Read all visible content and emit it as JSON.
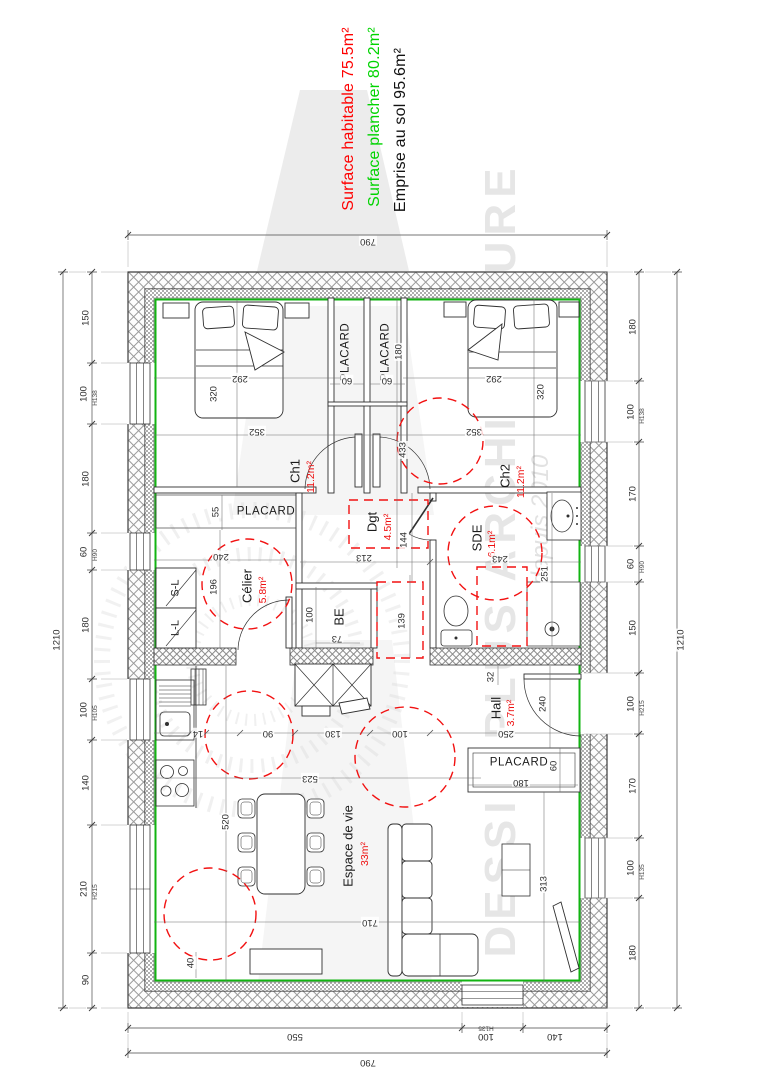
{
  "title_block": {
    "lines": [
      {
        "text": "Surface habitable 75.5m²",
        "color": "#ff0000"
      },
      {
        "text": "Surface plancher 80.2m²",
        "color": "#00d400"
      },
      {
        "text": "Emprise au sol 95.6m²",
        "color": "#121212"
      }
    ]
  },
  "watermark": {
    "name": "DESSIN PLUS ARCHITECTURE",
    "tagline": "depuis 2010"
  },
  "colors": {
    "surface_habitable_red": "#ff0000",
    "surface_plancher_green": "#00d400",
    "perimeter_green": "#12b412",
    "clearance_red": "#f21111",
    "wall_hatch_gray": "#9a9a9a"
  },
  "plan": {
    "overall": {
      "width_cm": "790",
      "height_cm": "1210"
    },
    "rooms": [
      {
        "name": "Ch1",
        "area": "11.2m²"
      },
      {
        "name": "Ch2",
        "area": "11.2m²"
      },
      {
        "name": "Dgt",
        "area": "4.5m²"
      },
      {
        "name": "SDE",
        "area": "6.1m²"
      },
      {
        "name": "Célier",
        "area": "5.8m²"
      },
      {
        "name": "Hall",
        "area": "3.7m²"
      },
      {
        "name": "Espace de vie",
        "area": "33m²"
      },
      {
        "name": "BE"
      },
      {
        "name": "S-L"
      },
      {
        "name": "L-L"
      },
      {
        "name": "PLACARD"
      }
    ],
    "labels": [
      {
        "t": "790",
        "x": 368,
        "y": 241,
        "r": 180,
        "c": "d"
      },
      {
        "t": "550",
        "x": 295,
        "y": 1036,
        "r": 180,
        "c": "d"
      },
      {
        "t": "100",
        "x": 486,
        "y": 1036,
        "r": 180,
        "c": "d"
      },
      {
        "t": "H135",
        "x": 486,
        "y": 1027,
        "r": 180,
        "c": "dt"
      },
      {
        "t": "140",
        "x": 555,
        "y": 1036,
        "r": 180,
        "c": "d"
      },
      {
        "t": "790",
        "x": 368,
        "y": 1062,
        "r": 180,
        "c": "d"
      },
      {
        "t": "1210",
        "x": 57,
        "y": 640,
        "r": -90,
        "c": "d"
      },
      {
        "t": "150",
        "x": 86,
        "y": 318,
        "r": -90,
        "c": "d"
      },
      {
        "t": "100",
        "x": 84,
        "y": 394,
        "r": -90,
        "c": "d"
      },
      {
        "t": "H138",
        "x": 96,
        "y": 398,
        "r": -90,
        "c": "dt"
      },
      {
        "t": "180",
        "x": 86,
        "y": 479,
        "r": -90,
        "c": "d"
      },
      {
        "t": "60",
        "x": 84,
        "y": 552,
        "r": -90,
        "c": "d"
      },
      {
        "t": "H90",
        "x": 96,
        "y": 555,
        "r": -90,
        "c": "dt"
      },
      {
        "t": "180",
        "x": 86,
        "y": 625,
        "r": -90,
        "c": "d"
      },
      {
        "t": "100",
        "x": 84,
        "y": 710,
        "r": -90,
        "c": "d"
      },
      {
        "t": "H105",
        "x": 96,
        "y": 713,
        "r": -90,
        "c": "dt"
      },
      {
        "t": "140",
        "x": 86,
        "y": 783,
        "r": -90,
        "c": "d"
      },
      {
        "t": "210",
        "x": 84,
        "y": 889,
        "r": -90,
        "c": "d"
      },
      {
        "t": "H215",
        "x": 96,
        "y": 892,
        "r": -90,
        "c": "dt"
      },
      {
        "t": "90",
        "x": 86,
        "y": 980,
        "r": -90,
        "c": "d"
      },
      {
        "t": "1210",
        "x": 681,
        "y": 640,
        "r": -90,
        "c": "d"
      },
      {
        "t": "180",
        "x": 633,
        "y": 327,
        "r": -90,
        "c": "d"
      },
      {
        "t": "100",
        "x": 631,
        "y": 412,
        "r": -90,
        "c": "d"
      },
      {
        "t": "H138",
        "x": 643,
        "y": 416,
        "r": -90,
        "c": "dt"
      },
      {
        "t": "170",
        "x": 633,
        "y": 494,
        "r": -90,
        "c": "d"
      },
      {
        "t": "60",
        "x": 631,
        "y": 564,
        "r": -90,
        "c": "d"
      },
      {
        "t": "H90",
        "x": 643,
        "y": 567,
        "r": -90,
        "c": "dt"
      },
      {
        "t": "150",
        "x": 633,
        "y": 628,
        "r": -90,
        "c": "d"
      },
      {
        "t": "100",
        "x": 631,
        "y": 704,
        "r": -90,
        "c": "d"
      },
      {
        "t": "H215",
        "x": 643,
        "y": 708,
        "r": -90,
        "c": "dt"
      },
      {
        "t": "170",
        "x": 633,
        "y": 786,
        "r": -90,
        "c": "d"
      },
      {
        "t": "100",
        "x": 631,
        "y": 868,
        "r": -90,
        "c": "d"
      },
      {
        "t": "H135",
        "x": 643,
        "y": 872,
        "r": -90,
        "c": "dt"
      },
      {
        "t": "180",
        "x": 633,
        "y": 953,
        "r": -90,
        "c": "d"
      },
      {
        "t": "292",
        "x": 240,
        "y": 378,
        "r": 180,
        "c": "d"
      },
      {
        "t": "320",
        "x": 214,
        "y": 394,
        "r": -90,
        "c": "d"
      },
      {
        "t": "352",
        "x": 257,
        "y": 431,
        "r": 180,
        "c": "d"
      },
      {
        "t": "292",
        "x": 494,
        "y": 378,
        "r": 180,
        "c": "d"
      },
      {
        "t": "320",
        "x": 541,
        "y": 392,
        "r": -90,
        "c": "d"
      },
      {
        "t": "352",
        "x": 474,
        "y": 431,
        "r": 180,
        "c": "d"
      },
      {
        "t": "PLACARD",
        "x": 346,
        "y": 352,
        "r": -90,
        "c": "pl"
      },
      {
        "t": "PLACARD",
        "x": 386,
        "y": 352,
        "r": -90,
        "c": "pl"
      },
      {
        "t": "60",
        "x": 347,
        "y": 380,
        "r": 180,
        "c": "d"
      },
      {
        "t": "60",
        "x": 387,
        "y": 380,
        "r": 180,
        "c": "d"
      },
      {
        "t": "180",
        "x": 399,
        "y": 352,
        "r": -90,
        "c": "d"
      },
      {
        "t": "Ch1",
        "x": 295,
        "y": 471,
        "r": -90,
        "c": "rm"
      },
      {
        "t": "11.2m²",
        "x": 311,
        "y": 477,
        "r": -90,
        "c": "ar"
      },
      {
        "t": "Ch2",
        "x": 505,
        "y": 476,
        "r": -90,
        "c": "rm"
      },
      {
        "t": "11.2m²",
        "x": 521,
        "y": 482,
        "r": -90,
        "c": "ar"
      },
      {
        "t": "433",
        "x": 403,
        "y": 450,
        "r": -90,
        "c": "d"
      },
      {
        "t": "PLACARD",
        "x": 266,
        "y": 512,
        "r": 0,
        "c": "pl"
      },
      {
        "t": "55",
        "x": 216,
        "y": 512,
        "r": -90,
        "c": "d"
      },
      {
        "t": "240",
        "x": 221,
        "y": 556,
        "r": 180,
        "c": "d"
      },
      {
        "t": "196",
        "x": 214,
        "y": 587,
        "r": -90,
        "c": "d"
      },
      {
        "t": "Célier",
        "x": 247,
        "y": 586,
        "r": -90,
        "c": "rm"
      },
      {
        "t": "5.8m²",
        "x": 263,
        "y": 590,
        "r": -90,
        "c": "ar"
      },
      {
        "t": "S-L",
        "x": 176,
        "y": 588,
        "r": -90,
        "c": "sm"
      },
      {
        "t": "L-L",
        "x": 176,
        "y": 628,
        "r": -90,
        "c": "sm"
      },
      {
        "t": "Dgt",
        "x": 372,
        "y": 522,
        "r": -90,
        "c": "rm"
      },
      {
        "t": "4.5m²",
        "x": 388,
        "y": 527,
        "r": -90,
        "c": "ar"
      },
      {
        "t": "213",
        "x": 364,
        "y": 557,
        "r": 180,
        "c": "d"
      },
      {
        "t": "144",
        "x": 404,
        "y": 540,
        "r": -90,
        "c": "d"
      },
      {
        "t": "139",
        "x": 402,
        "y": 621,
        "r": -90,
        "c": "d"
      },
      {
        "t": "BE",
        "x": 339,
        "y": 617,
        "r": -90,
        "c": "rm"
      },
      {
        "t": "100",
        "x": 310,
        "y": 615,
        "r": -90,
        "c": "d"
      },
      {
        "t": "73",
        "x": 337,
        "y": 638,
        "r": 180,
        "c": "d"
      },
      {
        "t": "SDE",
        "x": 477,
        "y": 538,
        "r": -90,
        "c": "rm"
      },
      {
        "t": "6.1m²",
        "x": 492,
        "y": 544,
        "r": -90,
        "c": "ar"
      },
      {
        "t": "243",
        "x": 500,
        "y": 558,
        "r": 180,
        "c": "d"
      },
      {
        "t": "251",
        "x": 545,
        "y": 574,
        "r": -90,
        "c": "d"
      },
      {
        "t": "32",
        "x": 491,
        "y": 677,
        "r": -90,
        "c": "d"
      },
      {
        "t": "Hall",
        "x": 496,
        "y": 708,
        "r": -90,
        "c": "rm"
      },
      {
        "t": "3.7m²",
        "x": 511,
        "y": 713,
        "r": -90,
        "c": "ar"
      },
      {
        "t": "240",
        "x": 543,
        "y": 704,
        "r": -90,
        "c": "d"
      },
      {
        "t": "250",
        "x": 506,
        "y": 733,
        "r": 180,
        "c": "d"
      },
      {
        "t": "PLACARD",
        "x": 519,
        "y": 763,
        "r": 0,
        "c": "pl"
      },
      {
        "t": "60",
        "x": 554,
        "y": 766,
        "r": -90,
        "c": "d"
      },
      {
        "t": "180",
        "x": 521,
        "y": 782,
        "r": 180,
        "c": "d"
      },
      {
        "t": "14",
        "x": 198,
        "y": 733,
        "r": 180,
        "c": "d"
      },
      {
        "t": "90",
        "x": 268,
        "y": 733,
        "r": 180,
        "c": "d"
      },
      {
        "t": "130",
        "x": 333,
        "y": 733,
        "r": 180,
        "c": "d"
      },
      {
        "t": "100",
        "x": 400,
        "y": 733,
        "r": 180,
        "c": "d"
      },
      {
        "t": "523",
        "x": 310,
        "y": 778,
        "r": 180,
        "c": "d"
      },
      {
        "t": "520",
        "x": 226,
        "y": 822,
        "r": -90,
        "c": "d"
      },
      {
        "t": "Espace de vie",
        "x": 348,
        "y": 846,
        "r": -90,
        "c": "rm"
      },
      {
        "t": "33m²",
        "x": 365,
        "y": 854,
        "r": -90,
        "c": "ar"
      },
      {
        "t": "710",
        "x": 370,
        "y": 922,
        "r": 180,
        "c": "d"
      },
      {
        "t": "313",
        "x": 544,
        "y": 884,
        "r": -90,
        "c": "d"
      },
      {
        "t": "40",
        "x": 191,
        "y": 963,
        "r": -90,
        "c": "d"
      }
    ]
  }
}
